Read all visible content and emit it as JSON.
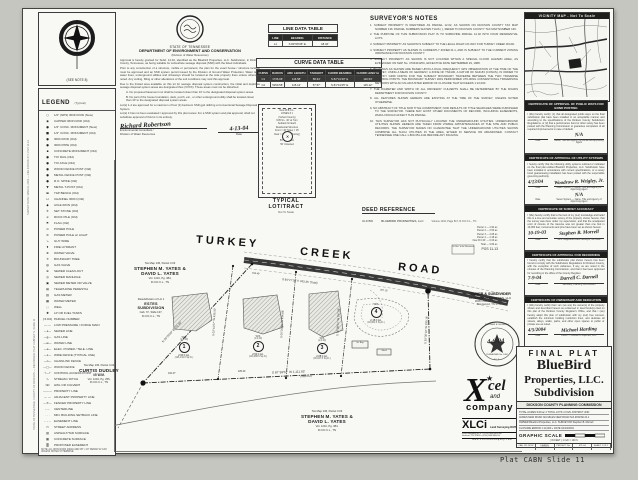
{
  "footer_label": "Plat CABN Slide 11",
  "margin_note_1": "SURVEY DATE: MARCH, 2004 — FIELD BOOK 471, PGS 11-13",
  "margin_note_2": "STATE OF TENNESSEE, COUNTY OF DICKSON — RECORDED: PLAT CABINET N, SLIDE 11",
  "north": {
    "note": "(SEE NOTE 8)"
  },
  "legend": {
    "title": "LEGEND",
    "title_suffix": "(Typical)",
    "footnote": "NOTE: ALL IRON RODS (NEW) ARE 5/8\" x 18\" REBAR W/ CAP, UNLESS NOTED OTHERWISE.",
    "items": [
      {
        "s": "○",
        "l": "1/2\" (NPS) IRON ROD (New)"
      },
      {
        "s": "◉",
        "l": "CAPPED IRON ROD (Old)"
      },
      {
        "s": "●",
        "l": "1/2\" CONC. MONUMENT (New)"
      },
      {
        "s": "■",
        "l": "1/2\" CONC. MONUMENT (Old)"
      },
      {
        "s": "●",
        "l": "IRON ROD (Old)"
      },
      {
        "s": "●",
        "l": "IRON PIPE (Old)"
      },
      {
        "s": "▪",
        "l": "CONCRETE MONUMENT (Old)"
      },
      {
        "s": "●",
        "l": "T/O RAIL (Old)"
      },
      {
        "s": "●",
        "l": "T/O AXLE (Old)"
      },
      {
        "s": "●",
        "l": "WOOD FENCE POST (Old)"
      },
      {
        "s": "●",
        "l": "METAL FENCE POST (Old)"
      },
      {
        "s": "●",
        "l": "R.O. SPIKE (Old)"
      },
      {
        "s": "▼",
        "l": "METAL T-POST (Old)"
      },
      {
        "s": "▬",
        "l": "T&P BENCH (Old)"
      },
      {
        "s": "⊔",
        "l": "CHANNEL IRON (Old)"
      },
      {
        "s": "◆",
        "l": "AXLE IRON (Old)"
      },
      {
        "s": "✛",
        "l": "SET STONE (Old)"
      },
      {
        "s": "⌀",
        "l": "ROCK PILE (Old)"
      },
      {
        "s": "⚑",
        "l": "FLAG (Old)"
      },
      {
        "s": "⊙",
        "l": "POWER POLE"
      },
      {
        "s": "⊘",
        "l": "POWER POLE w/ LIGHT"
      },
      {
        "s": "↘",
        "l": "GUY WIRE"
      },
      {
        "s": "♦",
        "l": "FIRE HYDRANT"
      },
      {
        "s": "⊗",
        "l": "WATER VALVE"
      },
      {
        "s": "✳",
        "l": "BOUNDARY TREE"
      },
      {
        "s": "◍",
        "l": "GAS VALVE"
      },
      {
        "s": "⊕",
        "l": "SEWER CLEAN-OUT"
      },
      {
        "s": "◎",
        "l": "SEWER MANHOLE"
      },
      {
        "s": "▣",
        "l": "SEWER METER OR VALVE"
      },
      {
        "s": "▤",
        "l": "TELEPHONE PEDESTAL"
      },
      {
        "s": "▥",
        "l": "GAS METER"
      },
      {
        "s": "▦",
        "l": "WATER METER"
      },
      {
        "s": "◌",
        "l": "WELL"
      },
      {
        "s": "✺",
        "l": "LP OR FUEL TANKS"
      },
      {
        "s": "(3.04)",
        "l": "PARCEL NUMBER"
      },
      {
        "s": "—·—",
        "l": "LOW PRESSURE / FORCE MAIN"
      },
      {
        "s": "—s—",
        "l": "SEWER LINE"
      },
      {
        "s": "—g—",
        "l": "GAS LINE"
      },
      {
        "s": "—w—",
        "l": "WATER LINE"
      },
      {
        "s": "—e—",
        "l": "ELEC. POWER / TELE. LINE"
      },
      {
        "s": "—x—",
        "l": "WIRE FENCE (TYPICAL USE)"
      },
      {
        "s": "—o—",
        "l": "CHAINLINK FENCE"
      },
      {
        "s": "—□—",
        "l": "WOOD FENCE"
      },
      {
        "s": "⊣—⊢",
        "l": "CONTROL ACCESS POINT"
      },
      {
        "s": "∿",
        "l": "STREAM / DITCH"
      },
      {
        "s": "⊐⊏",
        "l": "HWL OR CULVERT"
      },
      {
        "s": "———",
        "l": "PROPERTY LINE"
      },
      {
        "s": "— —",
        "l": "ADJACENT PROPERTY LINE"
      },
      {
        "s": "—✕—",
        "l": "FENCED PROPERTY LINE"
      },
      {
        "s": "–·–·",
        "l": "CENTERLINE"
      },
      {
        "s": "· · ·",
        "l": "MIN. BUILDING SETBACK LINE"
      },
      {
        "s": "– – –",
        "l": "EASEMENT LINE"
      },
      {
        "s": "▭",
        "l": "STREET ADDRESS"
      },
      {
        "s": "▨",
        "l": "ASPHALT/TAR SURFACE"
      },
      {
        "s": "▩",
        "l": "CONCRETE SURFACE"
      },
      {
        "s": "▒",
        "l": "PROPOSED EASEMENT"
      }
    ]
  },
  "dec_block": {
    "state": "STATE OF TENNESSEE",
    "dept": "DEPARTMENT OF ENVIRONMENT AND CONSERVATION",
    "division": "(Division of Water Resources)",
    "p1": "Approval is hereby granted for Subd. 12.02, identified as the Bluebird Properties, LLC. Subdivision, in Dickson County, Tennessee, as being suitable for subsurface sewage disposal (SSD) with the listed individuals.",
    "p2": "Prior to any construction of a structure, mobile or permanent, the plan for the exact house / structure location must be approved and an SSD system permit issued by the Division of Ground Water Protection. Water taps, water lines, underground utilities and driveways should be located at the side property lines unless otherwise noted. Any cutting, filling or other alterations of the soil conditions may void this approval.",
    "p3": "Due to the limited area available on this lot for sewage disposal system construction, the initial and duplicate sewage disposal system areas are designated thus (XXXX). These areas must not be disturbed.",
    "item_a": "A.  No proposed basement nor shall be located closer than 10' to the designated disposal system areas.",
    "item_b": "B.  No part of the house foundation, deck, porch, etc., or other underground utility shall be located closer than 10' to the designated disposal system areas.",
    "p4": "Lot(s)  1-4  are approved for a maximum of four (4) bedroom SSD gpd utilizing a Conventional Sewage Disposal System.",
    "p5": "Lot(s)  4  has not been evaluated / approved by this plat review. For a SSD system and plat approval, shall not substitute approval of this lot in its entirety.",
    "sig_name": "Richard Robertson",
    "sig_date": "4-13-04",
    "date_label": "Date",
    "title1": "Environmental Consultant /",
    "title2": "Division of Water Resources"
  },
  "line_table": {
    "title": "LINE DATA TABLE",
    "headers": [
      "LINE",
      "BEARING",
      "DISTANCE"
    ],
    "rows": [
      [
        "L1",
        "S 84°06'36\" E",
        "18.34'"
      ]
    ]
  },
  "curve_table": {
    "title": "CURVE DATA TABLE",
    "headers": [
      "CURVE",
      "RADIUS",
      "ARC LENGTH",
      "TANGENT",
      "CHORD BEARING",
      "CHORD LENGTH"
    ],
    "rows": [
      [
        "C1",
        "1736.06'",
        "116.58'",
        "58.34'",
        "S 82°31'40\" E",
        "116.54'"
      ],
      [
        "C2",
        "5259.58'",
        "115.12'",
        "57.57'",
        "S 81°41'25\" E",
        "115.12'"
      ]
    ]
  },
  "typical_lot": {
    "caption1": "TYPICAL",
    "caption2": "LOT/TRACT",
    "caption3": "Not To Scale",
    "center_mark": "✕",
    "labels": [
      "New  W.B.C.L.",
      "JONES # 1",
      "(School County)",
      "M.B.S.L. 40' at Turn",
      "Setback for Each",
      "Residential Structure",
      "Front = 40'   Sides = 15'",
      "Rear = 15'  (See Zoning)",
      "50' Water",
      "50' Collection",
      "50' Untested"
    ]
  },
  "surveyors_notes": {
    "title": "SURVEYOR'S NOTES",
    "notes": [
      "1.  SUBJECT PROPERTY IS IDENTIFIED AS PARCEL 12.02, AS SHOWN ON DICKSON COUNTY TAX MAP NUMBER 136. PARCEL NUMBERS SHOWN THUS ( ), REFER TO DICKSON COUNTY TAX MAP NUMBER 136.",
      "2.  THE PURPOSE OF THIS SUBDIVISION PLAT IS TO SUBDIVIDE PARCEL 12.02 INTO FOUR RESIDENTIAL LOTS.",
      "3.  SUBJECT PROPERTY AS SHOWN IS SUBJECT TO THE LEGAL RIGHT-OF-WAY FOR TURKEY CREEK ROAD.",
      "4.  SUBJECT PROPERTY AS SHOWN IS CURRENTLY ZONED R-1, AND IS SUBJECT TO THE CURRENT ZONING ORDINANCE FOR DICKSON COUNTY.",
      "5.  SUBJECT PROPERTY AS SHOWN IS NOT LOCATED WITHIN A SPECIAL FLOOD HAZARD AREA, AS EVIDENCED ON MAP No. 470430125C, EFFECTIVE DATE SEPTEMBER 29, 1988.",
      "6.  BEARINGS AS SHOWN ARE BASED UPON A DUAL FREQUENCY GPS OBSERVATION AT THE TIME OF THE SURVEY, USING A MEAN OF GEODESY, A ZONE OF TN4100, A DATUM OF NAD-83 (CONUS), IN ORDER TO RECTIFY GRID NORTH FOR THE SUBJECT BOUNDARY TRAVERSE BETWEEN THE TWO TRAVERSE CONTROL POINTS. THE BOUNDARY SURVEY WAS PERFORMED UTILIZING CONVENTIONAL TRAVERSING METHODS WITH AN UN-ADJUSTED ERROR OF CLOSURE THAT EXCEEDS 1:10,000.",
      "7.  THE DIAMETER AND WIDTH OF ALL DRIVEWAY CULVERTS SHALL BE DETERMINED BY THE ROADS DEPARTMENT FOR DICKSON COUNTY.",
      "8.  ALL FEATURES SHOWN HEREON ARE EXISTING AT THE TIME OF THE SURVEY, UNLESS NOTED OTHERWISE.",
      "9.  NO ABSTRACT OF TITLE NOR TITLE COMMITMENT, NOR RESULTS OF TITLE SEARCHES WERE FURNISHED TO THE SURVEYOR. THERE MAY EXIST OTHER DOCUMENTS OF RECORD, INCLUDING EASEMENTS, WHICH WOULD AFFECT THIS PARCEL.",
      "10. THIS SURVEYOR HAS NOT PHYSICALLY LOCATED THE UNDERGROUND UTILITIES. UNDERGROUND UTILITIES SHOWN HEREON ARE TAKEN FROM VISIBLE APPURTENANCES AT THE SITE AND PUBLIC RECORDS. THE SURVEYOR MAKES NO GUARANTEE THAT THE UNDERGROUND UTILITIES SHOWN COMPRISE ALL SUCH UTILITIES IN THE AREA, EITHER IN SERVICE OR ABANDONED. CONTACT TENNESSEE ONE CALL 1-800-351-1111 BEFORE ANY DIGGING."
    ]
  },
  "deed_reference": {
    "title": "DEED REFERENCE",
    "left": "OLD BID",
    "owner": "BLUEBIRD PROPERTIES, LLC",
    "ref": "Volume 1134, Page 817, R.O.D.C.L., TN"
  },
  "mini_table": {
    "rows": [
      "Parcel 1 — 2.90 ac.",
      "Parcel 2 — 2.53 ac.",
      "Parcel 3 — 2.08 ac.",
      "Parcel 4 — 2.18 ac.",
      "New R.O.W. — 0.00 ac.",
      "Total — 9.69 ac."
    ],
    "note": "PGS 11-13"
  },
  "vicinity": {
    "title": "VICINITY MAP - Not To Scale"
  },
  "certificates": [
    {
      "title": "CERTIFICATE OF APPROVAL OF PUBLIC WAYS FOR BOND POSTING",
      "body": "I (We) hereby certify: (1) that all designated public ways on the final subdivision plat have been installed in an acceptable manner and according to the specifications of the Dickson County Subdivision Regulations, or (2) that a performance bond or other surety has been posted with the Planning Commission to guarantee completion of all required improvements in case of default.",
      "sig1_date": "",
      "sig1_name": "N/A",
      "sig1_l1": "Date",
      "sig1_l2": "Name, Title and Agency of Authorized Approving Agent",
      "sig2_date": "",
      "sig2_name": "",
      "sig2_l1": "",
      "sig2_l2": ""
    },
    {
      "title": "CERTIFICATE OF APPROVAL OF UTILITY SYSTEMS",
      "body": "I hereby certify that the following utility systems outlined or indicated on the final plat entitled Bluebird Properties, LLC. Subdivision have been installed in accordance with current specifications, or a surety bond guaranteeing installation has been posted with the responsible governing authority.",
      "sig1_date": "4/13/04",
      "sig1_name": "Woodrow R. Wrigley, Jr.",
      "sig1_l1": "Date",
      "sig1_l2": "Water System — Name, Title and Agency of Approving Agent",
      "sig2_date": "",
      "sig2_name": "N/A",
      "sig2_l1": "Date",
      "sig2_l2": "Sewer System — Name, Title and Agency of Approving Agent"
    },
    {
      "title": "CERTIFICATE OF SURVEY ACCURACY",
      "body": "I (We) hereby certify that to the best of my (our) knowledge and belief this is a true and accurate survey of the property shown hereon, that the survey was done under my supervision, and that the unadjusted error of closure of the traverse was not greater than one foot in 10,000 feet; monuments and pins have been set as shown hereon.",
      "sig1_date": "10-19-03",
      "sig1_name": "Stephen B. Morrell",
      "sig1_l1": "Date",
      "sig1_l2": "Tenn. Registered Land Surveyor, No. 2462",
      "sig2_date": "",
      "sig2_name": "",
      "sig2_l1": "",
      "sig2_l2": ""
    },
    {
      "title": "CERTIFICATE OF APPROVAL FOR RECORDING",
      "body": "I hereby certify that the subdivision plat shown hereon has been found to comply with the Subdivision Regulations for Dickson County, with the exception of such variances, if any, as are noted in the minutes of the Planning Commission, and that it has been approved for recording in the office of the County Register.",
      "sig1_date": "7-9-04",
      "sig1_name": "Darrell C. Darnell",
      "sig1_l1": "Date",
      "sig1_l2": "Secretary, Planning Commission",
      "sig2_date": "",
      "sig2_name": "",
      "sig2_l1": "",
      "sig2_l2": ""
    },
    {
      "title": "CERTIFICATE OF OWNERSHIP AND DEDICATION",
      "body": "I (We) hereby certify that I am (we are) the owner(s) of the property shown and described hereon as evidenced in deed book(s) cited on this plat of the Dickson County Register's Office, and that I (we) hereby adopt this plan of subdivision with my (our) free consent, establish the minimum building restriction lines, and dedicate all streets, alleys, walks, parks, and other open spaces to public or private use as noted.",
      "sig1_date": "4/5/2004",
      "sig1_name": "Michael Harding",
      "sig1_l1": "Date",
      "sig1_l2": "Owner — Bluebird Properties, LLC.",
      "sig2_date": "",
      "sig2_name": "",
      "sig2_l1": "",
      "sig2_l2": ""
    }
  ],
  "title_block": {
    "final_plat": "FINAL PLAT",
    "name1": "BlueBird",
    "name2": "Properties, LLC.",
    "name3": "Subdivision",
    "commission": "DICKSON COUNTY PLANNING COMMISSION",
    "rows": [
      "TOTAL ACRES  9.69 ac.±     TOTAL LOTS  4     CIVIL DISTRICT  2ND",
      "ACRES NEW ROAD  N/A     MILES NEW ROAD  N/A     ZONING  R-1",
      "OWNER  Bluebird Properties, LLC.     SURVEYOR  Stephen B. Morrell",
      "CLOSURE ERROR  1:10,000 +     DATE  04/13/2004"
    ],
    "graphic_scale": "GRAPHIC SCALE",
    "scale_ticks": "100     0    50   100        200",
    "scale_note": "( IN FEET )  1 inch = 100 ft.",
    "bottom_cells": [
      "CAD. BY: RCW",
      "DRAWN: 04/13/04",
      "PROJECT No.",
      "471-04",
      "SHEET 1 OF 1"
    ]
  },
  "drawing": {
    "road_word1": "TURKEY",
    "road_word2": "CREEK",
    "road_word3": "ROAD",
    "road_bearing": "S 84°27'16\" E  433.35' (Total)",
    "dist_road_1": "158.49'",
    "dist_road_2": "267.10'",
    "dist_bottom_1": "162.47'",
    "dist_bottom_2": "225.44'",
    "bearing_bottom": "S 87°39'52\" W  1,111.93'",
    "bearing_bottom_sub": "(Total Dist.)",
    "bearing_left": "N 09°29'00\" E  272.48'",
    "bearing_lot12": "S 02°41'57\" W  435.50'",
    "bearing_lot23": "S 05°01'45\" W  434.86'",
    "bearing_lot34": "S 16°28'51\" W  357.06'",
    "bearing_right": "S 20°30'10\" W  299.16'",
    "lots": [
      {
        "num": "1",
        "ws": "W/S",
        "code": "(1-0.00)",
        "area": "2.90 ± Ac.",
        "sqft": "(126,144.0 Sq.Ft.)"
      },
      {
        "num": "2",
        "ws": "W/S",
        "code": "(1-0.00)",
        "area": "2.53 ± Ac.",
        "sqft": "(110,088.5 Sq.Ft.)"
      },
      {
        "num": "3",
        "ws": "W/S",
        "code": "(1-0.00)",
        "area": "2.08 ± Ac.",
        "sqft": "(90,647.5 Sq.Ft.)"
      },
      {
        "num": "4",
        "ws": "W/S",
        "code": "(1-0.00)",
        "area": "2.18 ± Ac.",
        "sqft": "(94,961.5 Sq.Ft.)"
      }
    ],
    "yates_top": {
      "l1": "Tax Map 136, Parcel 3.03",
      "nm1": "STEPHEN M. YATES &",
      "nm2": "DAVID L. YATES",
      "l2": "Vol. 1210, Pg. 384,",
      "l3": "R.O.D.C.L., TN"
    },
    "estes": {
      "l1": "Resubdivision of Lot 1",
      "nm1": "ESTES",
      "nm2": "SUBDIVISION",
      "l2": "Cab. 'D', Slide 137,",
      "l3": "R.O.D.C.L., TN"
    },
    "dudley": {
      "l1": "Tax Map 136, Parcel 4.02",
      "nm1": "CURTIS DUDLEY",
      "nm2": "#5 W.M.",
      "l2": "Vol. 1204, Pg. 256,",
      "l3": "R.O.D.C.L., TN"
    },
    "yates_bottom": {
      "l1": "Tax Map 136, Parcel 3.03",
      "nm1": "STEPHEN M. YATES &",
      "nm2": "DAVID L. YATES",
      "l2": "Vol. 1210, Pg. 384,",
      "l3": "R.O.D.C.L., TN"
    },
    "owner_block": {
      "t": "OWNER & SUBDIVIDER",
      "n": "BLUEBIRD PROPERTIES, LLC",
      "a1": "9005 Overlook Boulevard",
      "a2": "Brentwood, TN 37027"
    },
    "shed_label": "Gr. Bay",
    "shed_label2": "Shed",
    "removal_note": "Gr. Brn. to be Removed",
    "seal": {
      "name": "STEPHEN B. MORRELL",
      "tree": "✦",
      "no": "TENNESSEE No. 2462",
      "rls": "R.L.S.",
      "hand_date": "4-6-04"
    },
    "logo": {
      "x": "X",
      "star": "★",
      "cel": "cel",
      "and": "and",
      "company": "company",
      "brand": "XLCi",
      "tagline": "Land Surveying DIVISION",
      "addr1": "3054 Highway 46 S.  •  (615) 446-9933 ph",
      "addr2": "Dickson, TN 37055  •  (615) 446-9944 fx",
      "web": "w w w . x c e l a n d c o m p a n y . c o m"
    }
  },
  "colors": {
    "ink": "#1c1c1c",
    "paper": "#f8f8f4",
    "road": "#383838",
    "bar": "#1e1e1c"
  }
}
